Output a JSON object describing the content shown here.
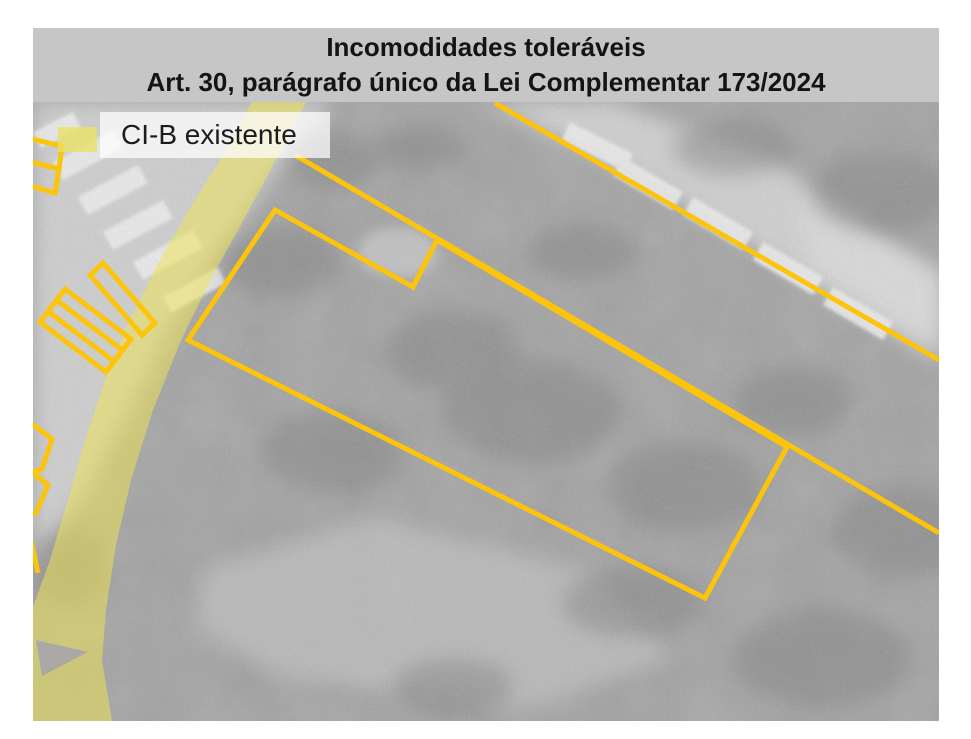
{
  "header": {
    "line1": "Incomodidades toleráveis",
    "line2": "Art. 30, parágrafo único da Lei Complementar 173/2024"
  },
  "legend": {
    "label": "CI-B existente"
  },
  "colors": {
    "page_bg": "#ffffff",
    "header_bg": "#c6c6c6",
    "header_text": "#141414",
    "outline_yellow": "#fcc40a",
    "road_yellow": "#efe553",
    "aerial_base": "#a3a3a3",
    "legend_box_bg": "rgba(255,255,255,0.72)",
    "legend_swatch": "rgba(235,226,100,0.78)",
    "legend_text": "#1c1c1c"
  },
  "map": {
    "overlays": [
      {
        "name": "ci-b-road-corridor",
        "style": "filled-yellow-band"
      },
      {
        "name": "parcel-boundaries",
        "style": "yellow-outline"
      }
    ]
  }
}
